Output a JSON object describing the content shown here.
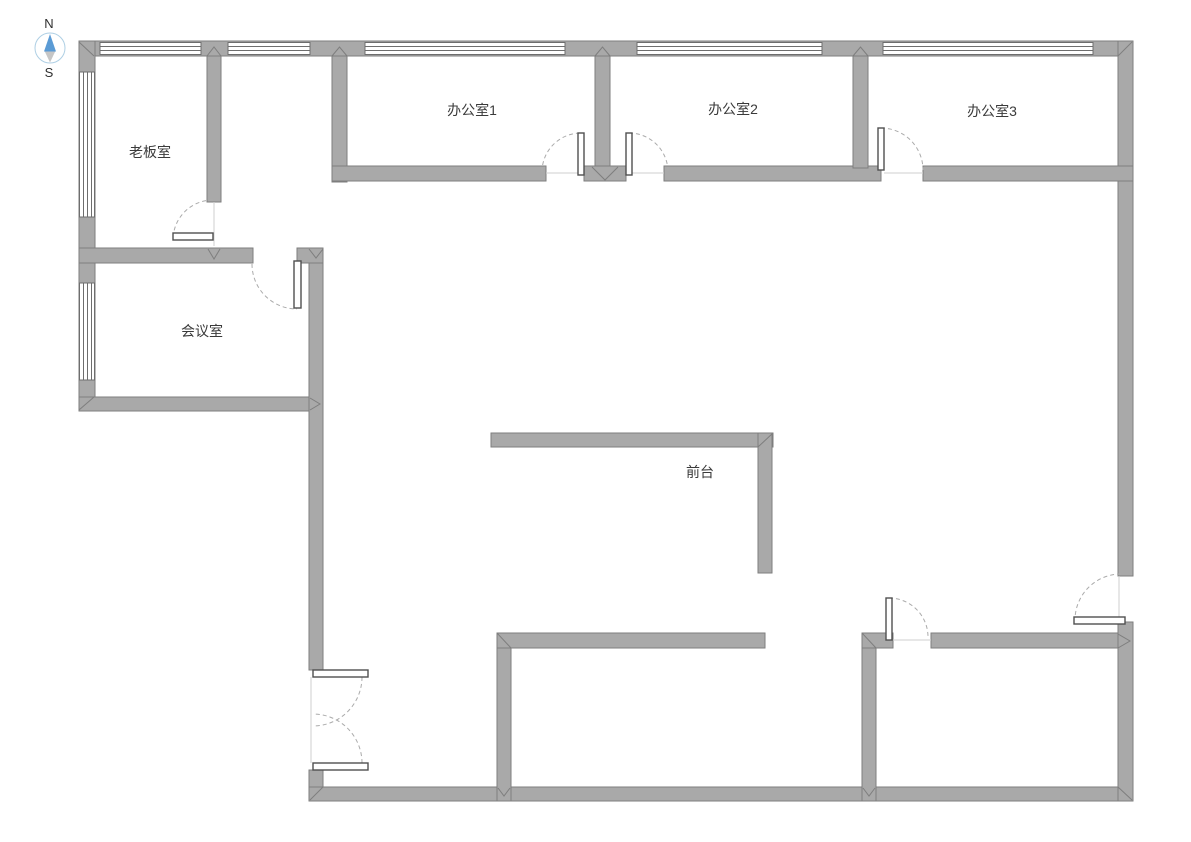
{
  "compass": {
    "north_label": "N",
    "south_label": "S",
    "needle_north_color": "#5b9bd5",
    "needle_south_color": "#c6c6c6",
    "ring_color": "#aecfe4"
  },
  "rooms": [
    {
      "id": "boss-office",
      "label": "老板室"
    },
    {
      "id": "office-1",
      "label": "办公室1"
    },
    {
      "id": "office-2",
      "label": "办公室2"
    },
    {
      "id": "office-3",
      "label": "办公室3"
    },
    {
      "id": "meeting-room",
      "label": "会议室"
    },
    {
      "id": "reception",
      "label": "前台"
    }
  ],
  "colors": {
    "background": "#ffffff",
    "wall_fill": "#a9a9a9",
    "wall_stroke": "#7e7e7e",
    "door_arc": "#ababab",
    "door_panel_stroke": "#4f4f4f",
    "window_line": "#6e6e6e",
    "label_text": "#3a3a3a"
  }
}
